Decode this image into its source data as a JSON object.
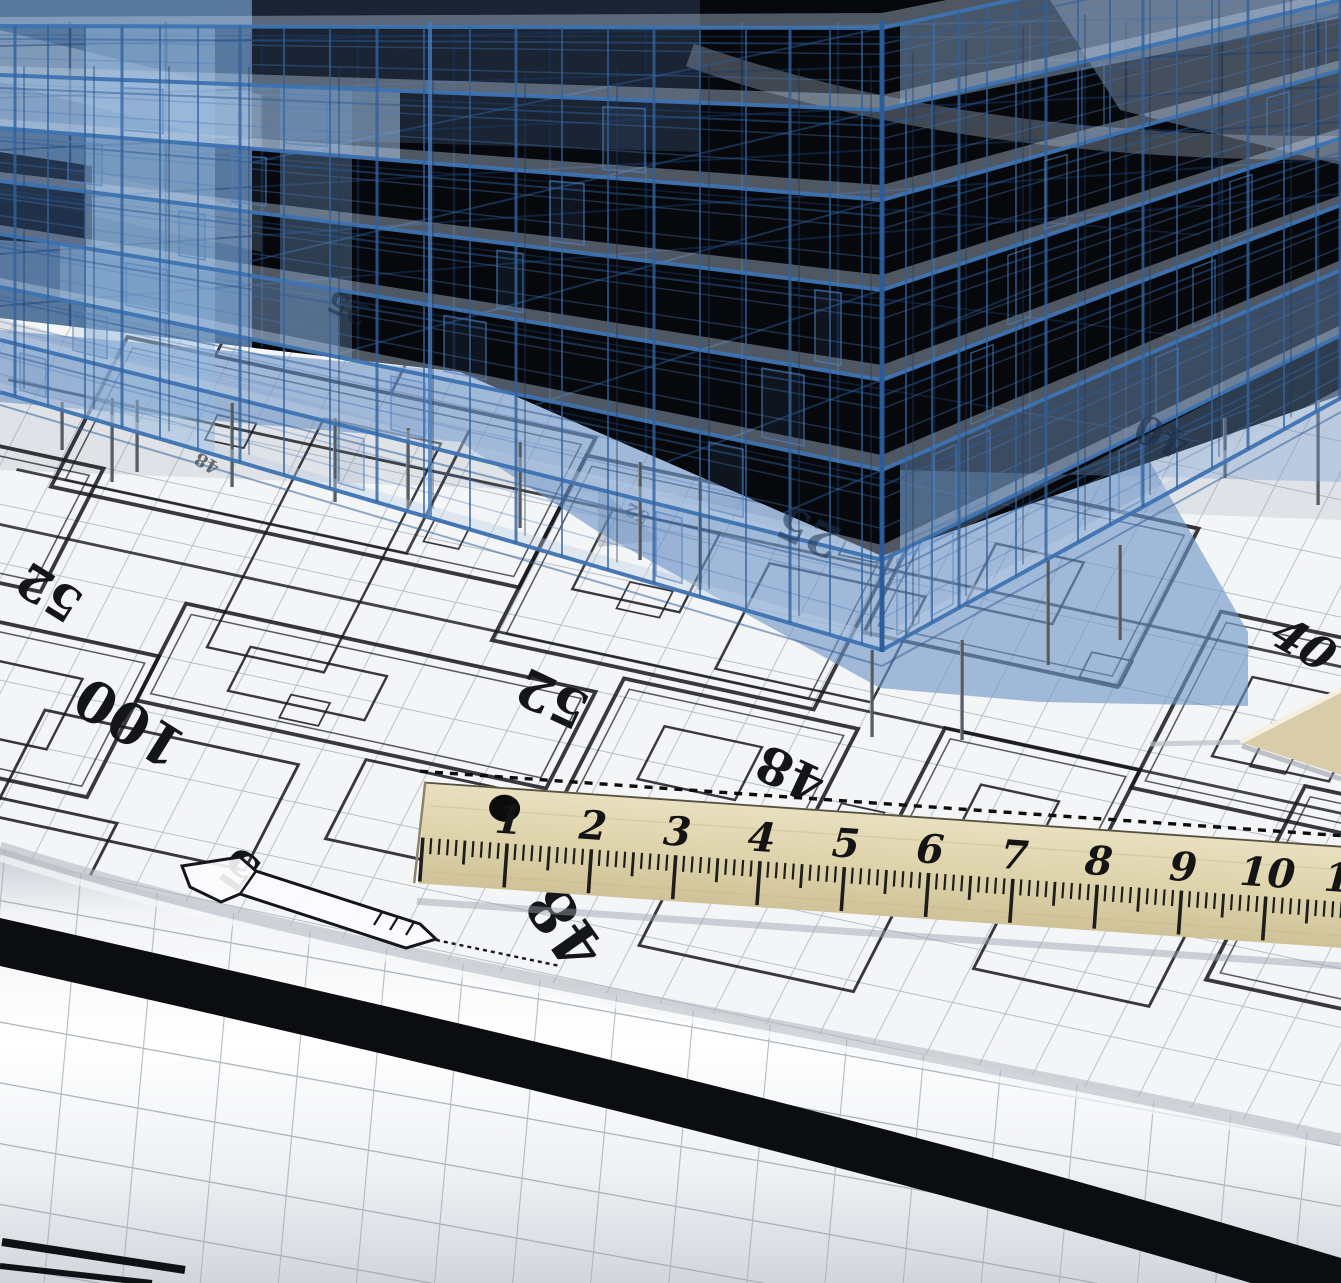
{
  "colors": {
    "background_black": "#06080c",
    "wireframe_blue": "#3e73b2",
    "wireframe_deep": "#1c3a63",
    "glass_blue": "#7fa6d2",
    "shadow_blue": "#6e94c6",
    "paper_white": "#f4f5f7",
    "grid_gray": "#b6bcc6",
    "plan_ink": "#16171b",
    "ruler_wood": "#ded3ab",
    "ruler_ink": "#141414",
    "roll_band_black": "#0c0d10",
    "roll_grid_gray": "#9aa3ae",
    "set_square_tan": "#d8cda8"
  },
  "blueprint_numbers": {
    "left_52": "52",
    "left_100": "100",
    "left_5": "5",
    "mid_52": "52",
    "mid_48": "48",
    "big_48": "48",
    "right_40": "40",
    "upper_40": "40",
    "band_25": "25",
    "band_25_left": "25",
    "small_48": "48",
    "small_52": "52"
  },
  "ruler": {
    "numbers": [
      "1",
      "2",
      "3",
      "4",
      "5",
      "6",
      "7",
      "8",
      "9",
      "10",
      "11"
    ]
  }
}
